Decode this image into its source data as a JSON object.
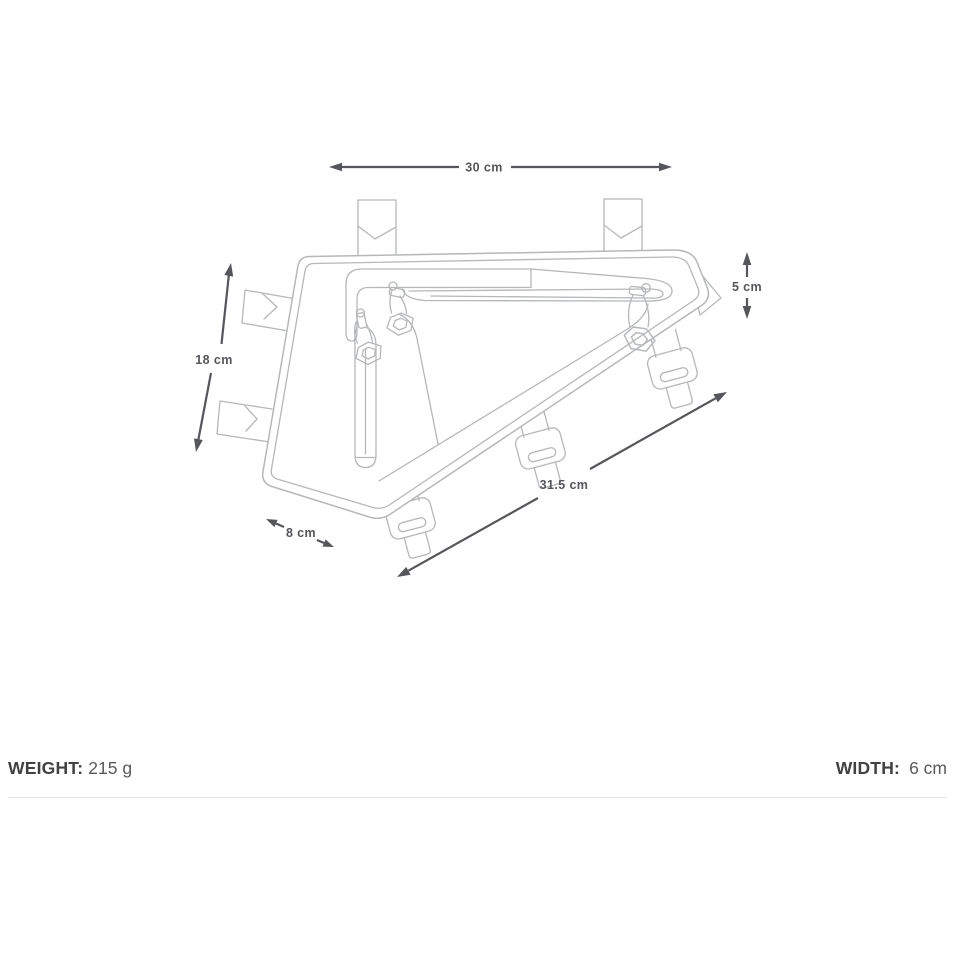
{
  "title": "Frame pack dimension line drawing",
  "dimensions": {
    "width_top": "30 cm",
    "height_right": "5 cm",
    "height_left": "18 cm",
    "length_bottom": "31.5 cm",
    "depth_front": "8 cm"
  },
  "specs": {
    "weight_label": "WEIGHT:",
    "weight_value": "215 g",
    "width_label": "WIDTH:",
    "width_value": "6 cm"
  },
  "colors": {
    "artwork_line": "#b5b7b9",
    "dimension": "#55565a",
    "spec_label": "#414042",
    "spec_value": "#58595b",
    "divider": "#e6e7e8",
    "background": "#ffffff"
  }
}
